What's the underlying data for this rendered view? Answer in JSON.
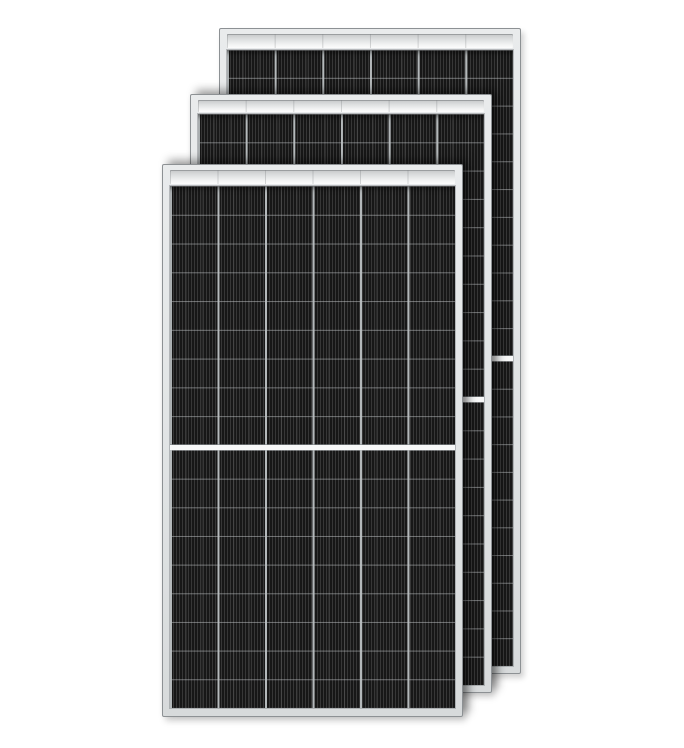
{
  "scene": {
    "description": "Product photo of three stacked black half-cut-cell solar panel modules with silver frames on a white background",
    "background_color": "#ffffff",
    "image_width": 684,
    "image_height": 748
  },
  "colors": {
    "cell_base": "#1f1f1f",
    "cell_stripe_dark": "#171717",
    "cell_stripe_light": "#373737",
    "cell_subline": "rgba(255,255,255,0.10)",
    "row_line": "rgba(198,202,205,0.50)",
    "column_line": "rgba(187,192,194,0.95)",
    "center_divider": "#f7f8f8",
    "divider_edge": "rgba(128,133,136,0.65)",
    "backsheet_bar_top": "#c5c7c8",
    "backsheet_bar_bottom": "#fdfdfd",
    "bar_tick": "rgba(108,112,114,0.28)",
    "frame_fill": "#e2e5e6",
    "frame_border": "#8d9194"
  },
  "panels": [
    {
      "name": "back",
      "x": 219,
      "y": 28,
      "width": 302,
      "height": 646,
      "columns": 6,
      "rows_per_half": 11,
      "cells_top": 21,
      "cells_bottom": 7,
      "cells_side": 7,
      "bar_top": 5,
      "divider_height": 5,
      "z": 1,
      "overlap_shadow": false
    },
    {
      "name": "middle",
      "x": 190,
      "y": 94,
      "width": 302,
      "height": 599,
      "columns": 6,
      "rows_per_half": 10,
      "cells_top": 19,
      "cells_bottom": 7,
      "cells_side": 7,
      "bar_top": 5,
      "divider_height": 5,
      "z": 2,
      "overlap_shadow": true
    },
    {
      "name": "front",
      "x": 162,
      "y": 164,
      "width": 301,
      "height": 553,
      "columns": 6,
      "rows_per_half": 9,
      "cells_top": 21,
      "cells_bottom": 8,
      "cells_side": 7,
      "bar_top": 5,
      "divider_height": 5,
      "z": 3,
      "overlap_shadow": true
    }
  ]
}
